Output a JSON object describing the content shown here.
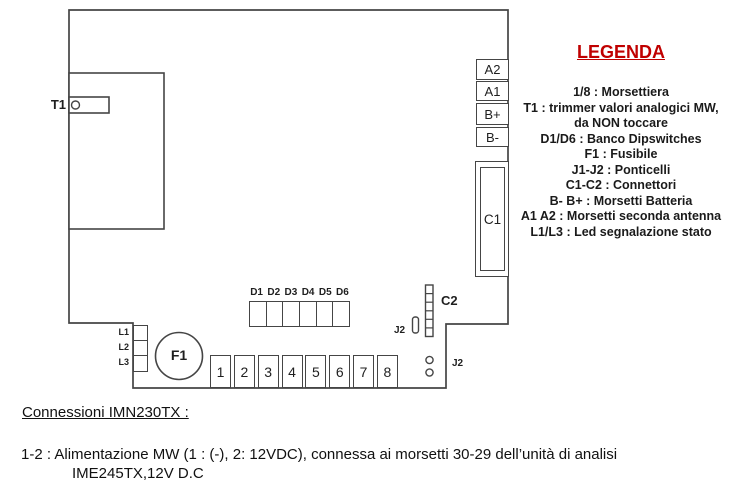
{
  "legend": {
    "title": "LEGENDA",
    "items": [
      "1/8 : Morsettiera",
      "T1 : trimmer valori analogici MW,",
      "da NON toccare",
      "D1/D6 : Banco Dipswitches",
      "F1 : Fusibile",
      "J1-J2 : Ponticelli",
      "C1-C2 : Connettori",
      "B- B+ : Morsetti Batteria",
      "A1 A2 : Morsetti seconda antenna",
      "L1/L3 : Led segnalazione stato"
    ]
  },
  "board": {
    "trimmer_label": "T1",
    "fuse_label": "F1",
    "connector1_label": "C1",
    "connector2_label": "C2",
    "jumper_top_label": "J2",
    "jumper_bottom_label": "J2",
    "antenna_terminals": [
      "A2",
      "A1",
      "B+",
      "B-"
    ],
    "dip_labels": [
      "D1",
      "D2",
      "D3",
      "D4",
      "D5",
      "D6"
    ],
    "led_labels": [
      "L1",
      "L2",
      "L3"
    ],
    "terminals": [
      "1",
      "2",
      "3",
      "4",
      "5",
      "6",
      "7",
      "8"
    ]
  },
  "footer": {
    "heading": "Connessioni IMN230TX :",
    "line1": "1-2 : Alimentazione MW (1 : (-), 2: 12VDC), connessa ai morsetti 30-29 dell’unità di analisi",
    "line2": "IME245TX,12V D.C"
  },
  "colors": {
    "accent_red": "#C00000",
    "line": "#454545"
  }
}
